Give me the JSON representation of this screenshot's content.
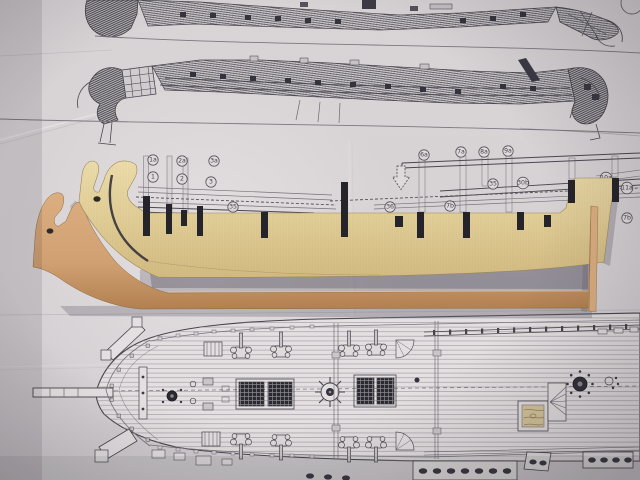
{
  "palette": {
    "paper": "#d8d4d6",
    "paperBright": "#e4e0e1",
    "paperDark": "#c2bec1",
    "ink": "#44414a",
    "inkLight": "#76727a",
    "plyLight": "#eedfae",
    "ply": "#e3d09a",
    "plyDark": "#d3bb82",
    "plyEdge": "#9a8857",
    "tanLight": "#dcae80",
    "tan": "#d0a072",
    "tanDark": "#b07e4e",
    "slot": "#26242b",
    "shadow": "#6f6a76"
  },
  "keel_plan": {
    "left_labels": [
      "1a",
      "1",
      "2a",
      "2",
      "3a",
      "3",
      "35"
    ],
    "right_labels": [
      "6a",
      "7a",
      "8a",
      "9a",
      "35",
      "36",
      "7b",
      "30b",
      "10a",
      "11a",
      "7b"
    ]
  }
}
